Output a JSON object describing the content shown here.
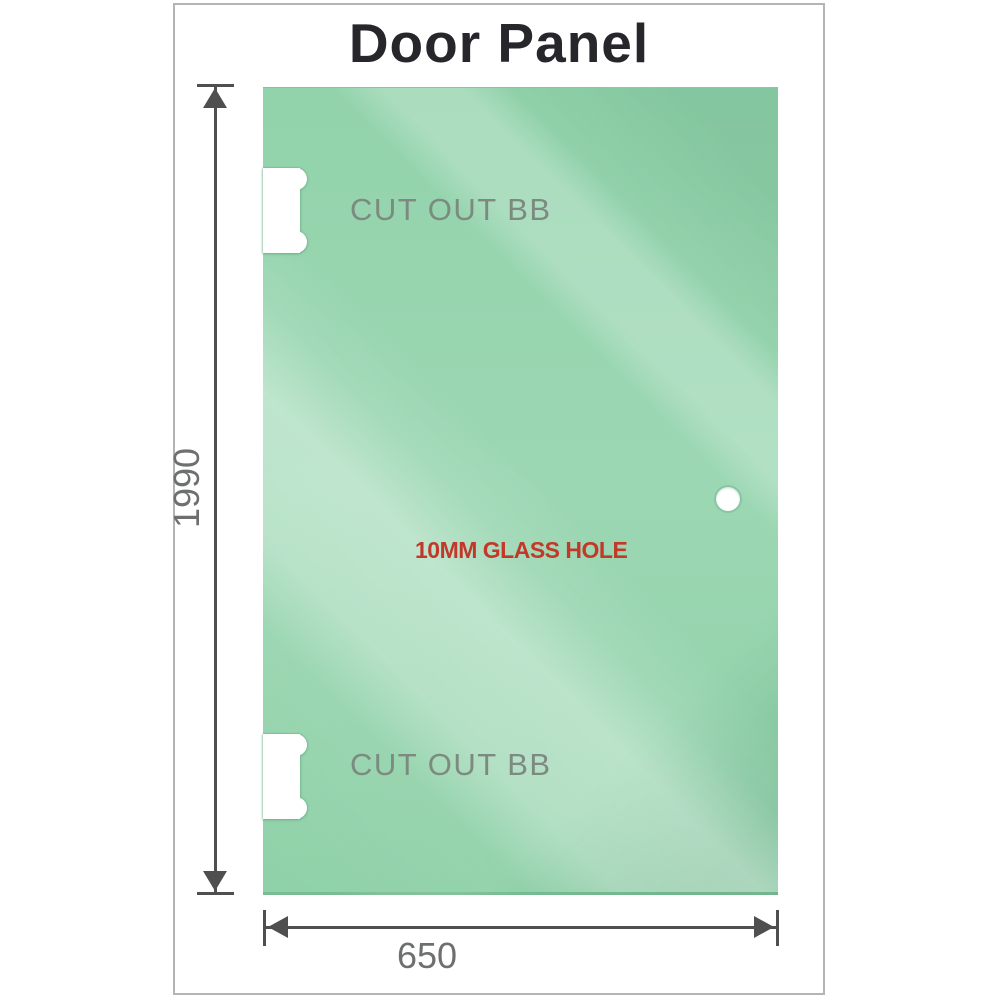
{
  "title": "Door Panel",
  "panel": {
    "cutouts": [
      {
        "label": "CUT OUT BB"
      },
      {
        "label": "CUT OUT BB"
      }
    ],
    "hole": {
      "label": "10MM GLASS HOLE"
    }
  },
  "dimensions": {
    "height": "1990",
    "width": "650"
  },
  "colors": {
    "glass_green": "#95d4ae",
    "glass_highlight": "#c9ecd7",
    "glass_shadow": "#7fc79a",
    "dimension_line": "#4f4f4f",
    "dimension_label": "#6e7070",
    "cutout_label": "#7c8a80",
    "hole_label": "#c23829",
    "title_text": "#26262b",
    "frame_border": "#b4b4b4"
  }
}
